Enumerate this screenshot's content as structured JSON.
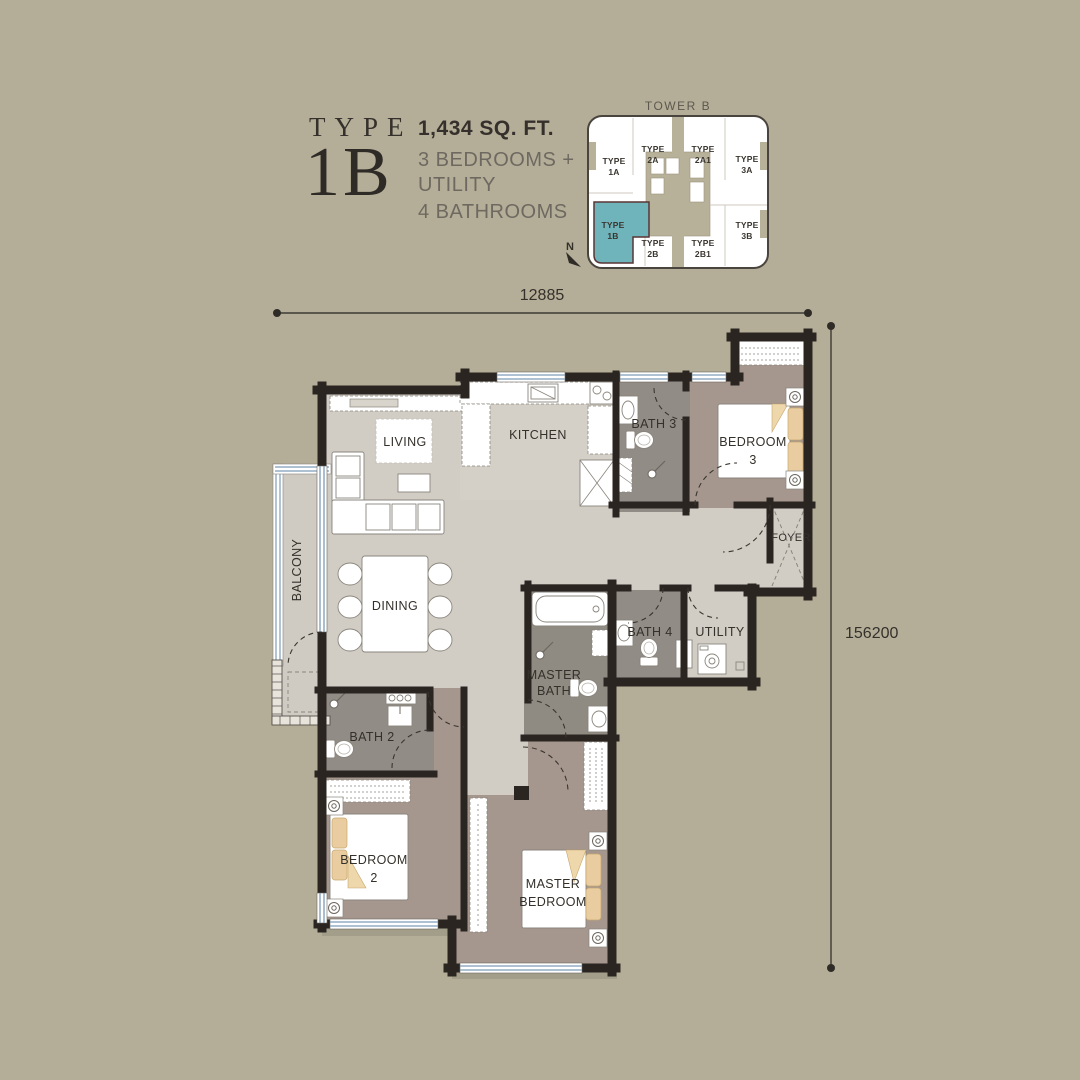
{
  "header": {
    "type_label": "TYPE",
    "type_value": "1B",
    "area": "1,434 SQ. FT.",
    "line1": "3 BEDROOMS +",
    "line2": "UTILITY",
    "line3": "4 BATHROOMS"
  },
  "key_plan": {
    "title": "TOWER B",
    "north": "N",
    "highlight_color": "#6fb4bb",
    "units": [
      {
        "l1": "TYPE",
        "l2": "1A"
      },
      {
        "l1": "TYPE",
        "l2": "2A"
      },
      {
        "l1": "TYPE",
        "l2": "2A1"
      },
      {
        "l1": "TYPE",
        "l2": "3A"
      },
      {
        "l1": "TYPE",
        "l2": "1B"
      },
      {
        "l1": "TYPE",
        "l2": "2B"
      },
      {
        "l1": "TYPE",
        "l2": "2B1"
      },
      {
        "l1": "TYPE",
        "l2": "3B"
      }
    ]
  },
  "dimensions": {
    "width": "12885",
    "height": "156200"
  },
  "rooms": {
    "living": "LIVING",
    "kitchen": "KITCHEN",
    "dining": "DINING",
    "balcony": "BALCONY",
    "bath3": "BATH 3",
    "bath4": "BATH 4",
    "bath2": "BATH 2",
    "utility": "UTILITY",
    "foyer": "FOYER",
    "master_bath_l1": "MASTER",
    "master_bath_l2": "BATH",
    "bedroom3_l1": "BEDROOM",
    "bedroom3_l2": "3",
    "bedroom2_l1": "BEDROOM",
    "bedroom2_l2": "2",
    "master_bedroom_l1": "MASTER",
    "master_bedroom_l2": "BEDROOM"
  },
  "colors": {
    "background": "#b4ae98",
    "wall": "#2b2522",
    "floor_light": "#d1cdc5",
    "floor_bedroom": "#a5978e",
    "floor_bath": "#918c85",
    "window_blue": "#7e9cb6",
    "pillow_tan": "#e9cda0",
    "highlight_teal": "#6fb4bb"
  }
}
